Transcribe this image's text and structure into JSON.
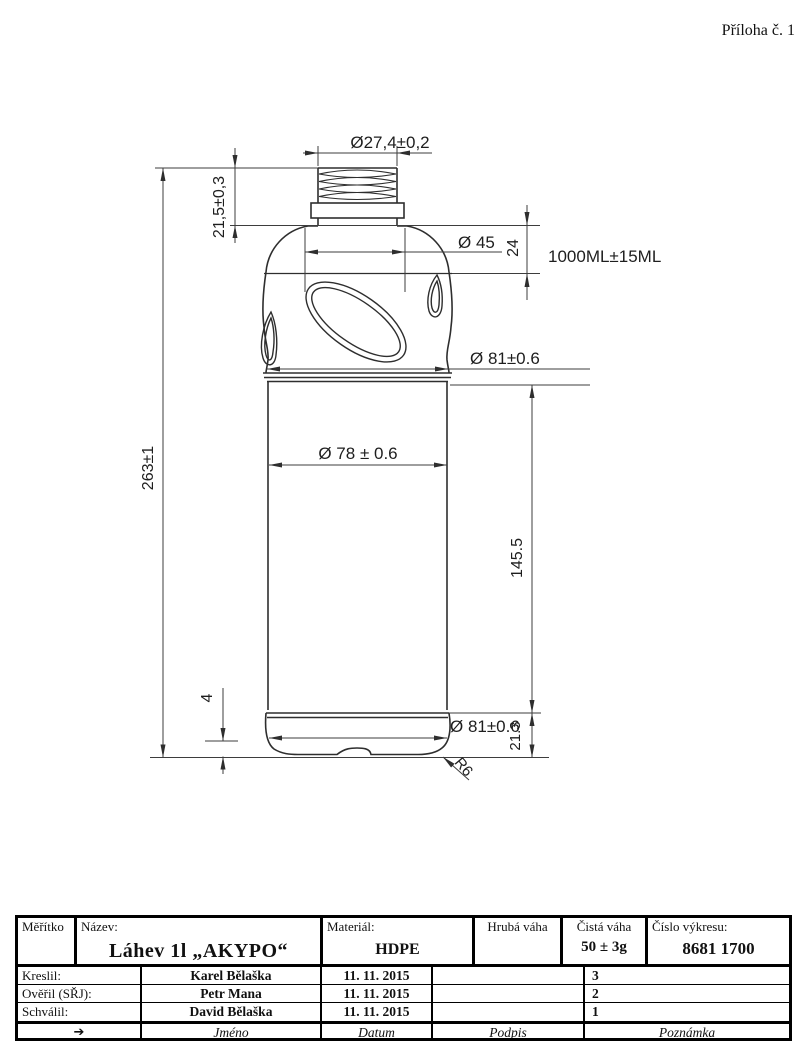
{
  "page": {
    "attachment_label": "Příloha č. 1"
  },
  "drawing": {
    "dims": {
      "neck_thread_diameter": "Ø27,4±0,2",
      "neck_height": "21,5±0,3",
      "total_height": "263±1",
      "neck_base_diameter": "Ø 45",
      "shoulder_height": "24",
      "volume": "1000ML±15ML",
      "shoulder_max_diameter": "Ø 81±0.6",
      "body_diameter": "Ø 78 ± 0.6",
      "body_height": "145.5",
      "base_ring_height": "4",
      "base_diameter": "Ø 81±0.6",
      "base_section_height": "21.3",
      "base_corner_radius": "R6"
    }
  },
  "title_block": {
    "scale_label": "Měřítko",
    "name_label": "Název:",
    "name_value": "Láhev 1l „AKYPO“",
    "material_label": "Materiál:",
    "material_value": "HDPE",
    "gross_weight_label": "Hrubá váha",
    "net_weight_label": "Čistá váha",
    "net_weight_value": "50 ± 3g",
    "drawing_number_label": "Číslo výkresu:",
    "drawing_number_value": "8681 1700",
    "rows": [
      {
        "role": "Kreslil:",
        "name": "Karel Bělaška",
        "date": "11. 11. 2015",
        "signature": "",
        "note": "3"
      },
      {
        "role": "Ověřil (SŘJ):",
        "name": "Petr Mana",
        "date": "11. 11. 2015",
        "signature": "",
        "note": "2"
      },
      {
        "role": "Schválil:",
        "name": "David Bělaška",
        "date": "11. 11. 2015",
        "signature": "",
        "note": "1"
      }
    ],
    "footer": {
      "arrow": "➔",
      "name": "Jméno",
      "date": "Datum",
      "signature": "Podpis",
      "note": "Poznámka"
    }
  }
}
